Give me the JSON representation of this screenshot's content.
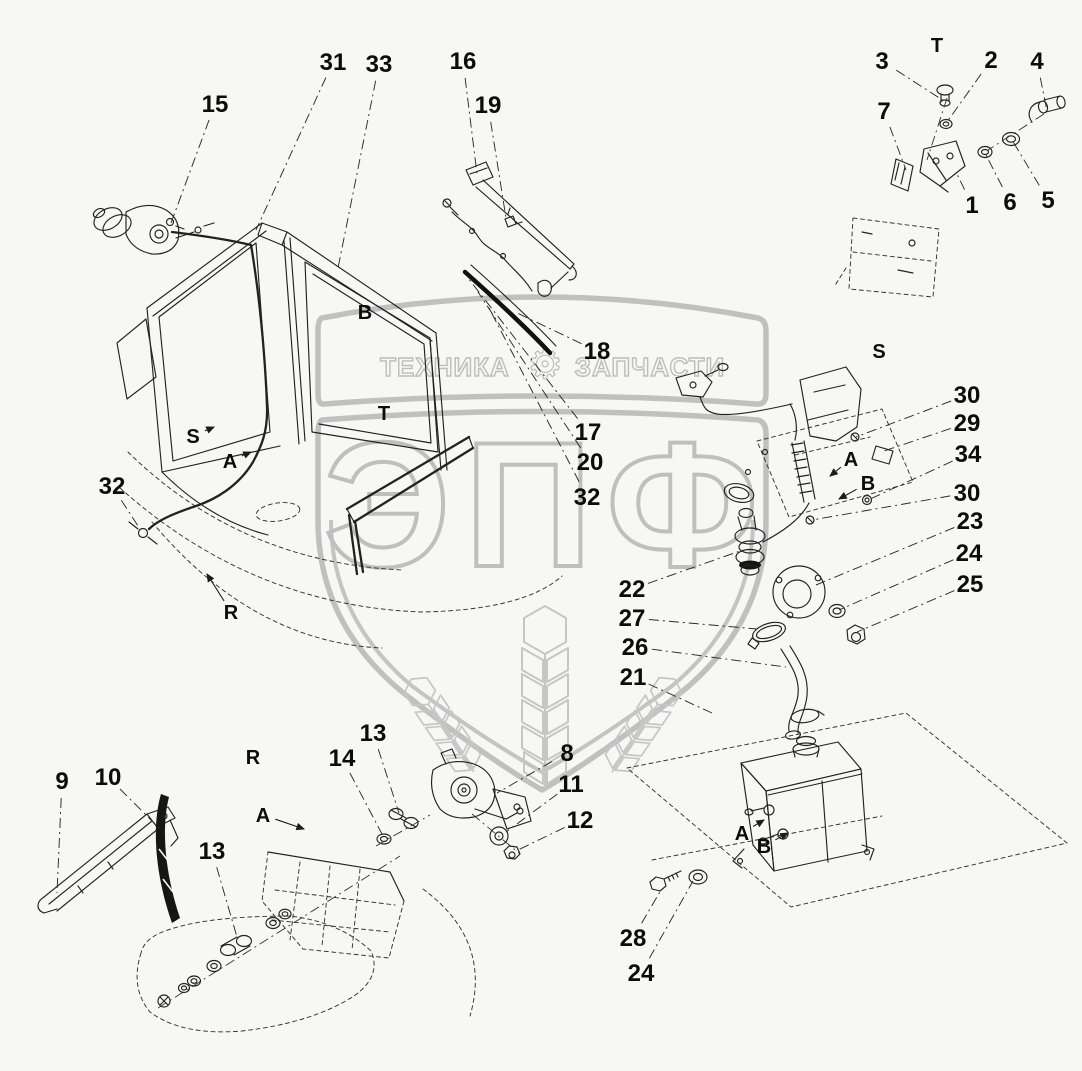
{
  "colors": {
    "background": "#f7f7f4",
    "line": "#222222",
    "watermark": "#c0c0c0",
    "label": "#0c0c0c"
  },
  "watermark": {
    "brand_left": "ТЕХНИКА",
    "brand_right": "ЗАПЧАСТИ",
    "gear_icon": "⚙",
    "logo_text": "ЭПФ"
  },
  "diagram": {
    "callouts": [
      {
        "kind": "number",
        "label": "15",
        "x": 215,
        "y": 104,
        "t": [
          171,
          223
        ]
      },
      {
        "kind": "number",
        "label": "31",
        "x": 333,
        "y": 62,
        "t": [
          256,
          230
        ]
      },
      {
        "kind": "number",
        "label": "33",
        "x": 379,
        "y": 64,
        "t": [
          338,
          268
        ]
      },
      {
        "kind": "number",
        "label": "16",
        "x": 463,
        "y": 61,
        "t": [
          477,
          174
        ]
      },
      {
        "kind": "number",
        "label": "19",
        "x": 488,
        "y": 105,
        "t": [
          506,
          218
        ]
      },
      {
        "kind": "number",
        "label": "3",
        "x": 882,
        "y": 61,
        "t": [
          944,
          101
        ]
      },
      {
        "kind": "number",
        "label": "2",
        "x": 991,
        "y": 60,
        "t": [
          947,
          122
        ]
      },
      {
        "kind": "number",
        "label": "4",
        "x": 1037,
        "y": 61,
        "t": [
          1047,
          111
        ]
      },
      {
        "kind": "number",
        "label": "7",
        "x": 884,
        "y": 111,
        "t": [
          906,
          170
        ]
      },
      {
        "kind": "number",
        "label": "1",
        "x": 972,
        "y": 205,
        "t": [
          956,
          172
        ]
      },
      {
        "kind": "number",
        "label": "6",
        "x": 1010,
        "y": 202,
        "t": [
          985,
          153
        ]
      },
      {
        "kind": "number",
        "label": "5",
        "x": 1048,
        "y": 200,
        "t": [
          1012,
          140
        ]
      },
      {
        "kind": "number",
        "label": "18",
        "x": 597,
        "y": 351,
        "t": [
          515,
          312
        ]
      },
      {
        "kind": "number",
        "label": "17",
        "x": 588,
        "y": 432,
        "t": [
          468,
          278
        ]
      },
      {
        "kind": "number",
        "label": "20",
        "x": 590,
        "y": 462,
        "t": [
          478,
          292
        ]
      },
      {
        "kind": "number",
        "label": "32",
        "x": 587,
        "y": 497,
        "t": [
          488,
          306
        ]
      },
      {
        "kind": "number",
        "label": "30",
        "x": 967,
        "y": 395,
        "t": [
          856,
          437
        ]
      },
      {
        "kind": "number",
        "label": "29",
        "x": 967,
        "y": 423,
        "t": [
          884,
          451
        ]
      },
      {
        "kind": "number",
        "label": "34",
        "x": 968,
        "y": 454,
        "t": [
          868,
          500
        ]
      },
      {
        "kind": "number",
        "label": "30",
        "x": 967,
        "y": 493,
        "t": [
          812,
          520
        ]
      },
      {
        "kind": "number",
        "label": "23",
        "x": 970,
        "y": 521,
        "t": [
          816,
          585
        ]
      },
      {
        "kind": "number",
        "label": "24",
        "x": 969,
        "y": 553,
        "t": [
          839,
          610
        ]
      },
      {
        "kind": "number",
        "label": "25",
        "x": 970,
        "y": 584,
        "t": [
          857,
          632
        ]
      },
      {
        "kind": "number",
        "label": "22",
        "x": 632,
        "y": 589,
        "t": [
          740,
          551
        ]
      },
      {
        "kind": "number",
        "label": "27",
        "x": 632,
        "y": 618,
        "t": [
          757,
          629
        ]
      },
      {
        "kind": "number",
        "label": "26",
        "x": 635,
        "y": 647,
        "t": [
          786,
          667
        ]
      },
      {
        "kind": "number",
        "label": "21",
        "x": 633,
        "y": 677,
        "t": [
          712,
          713
        ]
      },
      {
        "kind": "number",
        "label": "32",
        "x": 112,
        "y": 486,
        "t": [
          140,
          529
        ]
      },
      {
        "kind": "number",
        "label": "13",
        "x": 373,
        "y": 733,
        "t": [
          399,
          813
        ]
      },
      {
        "kind": "number",
        "label": "14",
        "x": 342,
        "y": 758,
        "t": [
          382,
          834
        ]
      },
      {
        "kind": "number",
        "label": "8",
        "x": 567,
        "y": 753,
        "t": [
          497,
          793
        ]
      },
      {
        "kind": "number",
        "label": "11",
        "x": 571,
        "y": 784,
        "t": [
          506,
          832
        ]
      },
      {
        "kind": "number",
        "label": "12",
        "x": 580,
        "y": 820,
        "t": [
          516,
          851
        ]
      },
      {
        "kind": "number",
        "label": "9",
        "x": 62,
        "y": 781,
        "t": [
          57,
          893
        ]
      },
      {
        "kind": "number",
        "label": "10",
        "x": 108,
        "y": 777,
        "t": [
          164,
          833
        ]
      },
      {
        "kind": "number",
        "label": "13",
        "x": 212,
        "y": 851,
        "t": [
          237,
          937
        ]
      },
      {
        "kind": "number",
        "label": "28",
        "x": 633,
        "y": 938,
        "t": [
          661,
          890
        ]
      },
      {
        "kind": "number",
        "label": "24",
        "x": 641,
        "y": 973,
        "t": [
          693,
          881
        ]
      },
      {
        "kind": "letter",
        "label": "T",
        "x": 937,
        "y": 45
      },
      {
        "kind": "letter",
        "label": "B",
        "x": 365,
        "y": 312
      },
      {
        "kind": "letter",
        "label": "S",
        "x": 879,
        "y": 351
      },
      {
        "kind": "letter",
        "label": "T",
        "x": 384,
        "y": 413
      },
      {
        "kind": "letter",
        "label": "S",
        "x": 193,
        "y": 436,
        "t": [
          214,
          427
        ]
      },
      {
        "kind": "letter",
        "label": "A",
        "x": 230,
        "y": 461,
        "t": [
          251,
          452
        ]
      },
      {
        "kind": "letter",
        "label": "R",
        "x": 231,
        "y": 612,
        "t": [
          207,
          574
        ]
      },
      {
        "kind": "letter",
        "label": "R",
        "x": 253,
        "y": 757
      },
      {
        "kind": "letter",
        "label": "A",
        "x": 851,
        "y": 459,
        "t": [
          830,
          476
        ]
      },
      {
        "kind": "letter",
        "label": "B",
        "x": 868,
        "y": 483,
        "t": [
          839,
          499
        ]
      },
      {
        "kind": "letter",
        "label": "A",
        "x": 263,
        "y": 815,
        "t": [
          304,
          829
        ]
      },
      {
        "kind": "letter",
        "label": "A",
        "x": 742,
        "y": 833,
        "t": [
          764,
          820
        ]
      },
      {
        "kind": "letter",
        "label": "B",
        "x": 764,
        "y": 846,
        "t": [
          788,
          833
        ]
      }
    ]
  }
}
